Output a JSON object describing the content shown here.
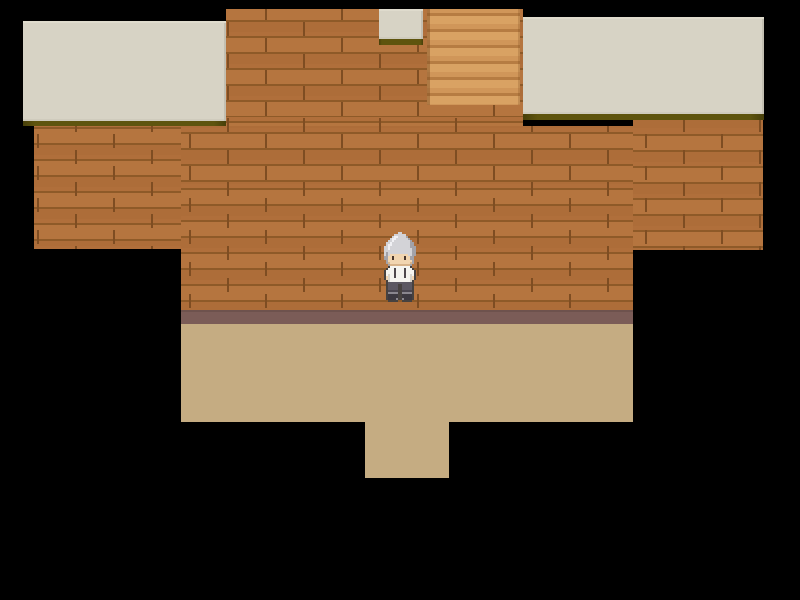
{
  "meta": {
    "description": "Top-down 2D RPG interior scene: brown wooden-plank walls, beige ceiling panels, a staircase at top center, tan floor with lower doorway, and a gray-haired character standing at center. No on-screen text.",
    "viewport": {
      "width": 800,
      "height": 600
    }
  },
  "scene": {
    "background_color": "#000000",
    "palette": {
      "wall_base": "#b5753f",
      "wall_groove": "#8e5a28",
      "wall_joint": "#7e4d22",
      "stairs_light": "#d9a263",
      "stairs_mid": "#d09659",
      "stairs_groove": "#b67c42",
      "ceiling": "#d7d3c5",
      "ceiling_shadow": "#5e540e",
      "baseboard": "#7b5c57",
      "floor": "#c5ac82",
      "void": "#000000"
    },
    "regions": [
      {
        "name": "wall-top-column",
        "type": "wall",
        "x": 226,
        "y": 9,
        "w": 297,
        "h": 117,
        "interactable": false
      },
      {
        "name": "wall-left-wing",
        "type": "wall",
        "x": 34,
        "y": 126,
        "w": 147,
        "h": 123,
        "interactable": false
      },
      {
        "name": "wall-center",
        "type": "wall",
        "x": 181,
        "y": 126,
        "w": 452,
        "h": 184,
        "interactable": false
      },
      {
        "name": "wall-right-wing",
        "type": "wall",
        "x": 633,
        "y": 120,
        "w": 130,
        "h": 130,
        "interactable": false
      },
      {
        "name": "staircase",
        "type": "stairs",
        "x": 427,
        "y": 9,
        "w": 93,
        "h": 96,
        "interactable": true
      },
      {
        "name": "ceiling-panel-left",
        "type": "ceiling",
        "x": 23,
        "y": 21,
        "w": 203,
        "h": 100,
        "interactable": false
      },
      {
        "name": "ceiling-shadow-left",
        "type": "shadow",
        "x": 23,
        "y": 121,
        "w": 203,
        "h": 5,
        "interactable": false
      },
      {
        "name": "ceiling-panel-right",
        "type": "ceiling",
        "x": 523,
        "y": 17,
        "w": 241,
        "h": 97,
        "interactable": false
      },
      {
        "name": "ceiling-shadow-right",
        "type": "shadow",
        "x": 523,
        "y": 114,
        "w": 241,
        "h": 6,
        "interactable": false
      },
      {
        "name": "ceiling-panel-top-door",
        "type": "ceiling",
        "x": 379,
        "y": 9,
        "w": 44,
        "h": 30,
        "interactable": false
      },
      {
        "name": "ceiling-shadow-top-door",
        "type": "shadow",
        "x": 379,
        "y": 39,
        "w": 44,
        "h": 6,
        "interactable": false
      },
      {
        "name": "baseboard-strip",
        "type": "baseboard",
        "x": 181,
        "y": 310,
        "w": 452,
        "h": 14,
        "interactable": false
      },
      {
        "name": "floor-main",
        "type": "floor",
        "x": 181,
        "y": 324,
        "w": 452,
        "h": 98,
        "interactable": true
      },
      {
        "name": "floor-entry-south",
        "type": "floor",
        "x": 365,
        "y": 422,
        "w": 84,
        "h": 56,
        "interactable": true
      }
    ],
    "character": {
      "name": "gray-haired-villager",
      "facing": "down",
      "x": 382,
      "y": 232,
      "width": 36,
      "height": 70,
      "cols": 18,
      "pixel_palette": {
        "O": "#474240",
        "H": "#d3d3d7",
        "W": "#f1f1f4",
        "h": "#a2a2a8",
        "S": "#f1d5b0",
        "s": "#d7b38a",
        "E": "#49362c",
        "T": "#f5f4ef",
        "t": "#d8d5cd",
        "D": "#4e484c",
        "P": "#5c5862",
        "p": "#4a4650",
        "B": "#3c3941",
        "b": "#8a878f"
      },
      "rows": [
        "........HH........",
        "......HHHHHH......",
        ".....HWWHHHHh.....",
        "....HWWHHHHHHh....",
        "...HHWHHHHHHHHh...",
        "..HHWHHHHHHHHHhh..",
        "..HWWHHHHHHHHHhh..",
        ".HHWHHHHHHHHHHhhh.",
        ".HHWHHHHHHHHHHHhh.",
        ".HHHHHHHHHHHHHHhh.",
        ".HhHHHHHHHHHHHHhh.",
        ".HhHSSSSSSSSSHHhh.",
        ".hhSSESSSSSESShh..",
        ".hhSSESSSSSESShh..",
        "..hSSSSSSSSSSSSh..",
        "..hsSSSSSSSSSSsh..",
        "...hssssssssssh...",
        "...OTTTTTTTTTTO...",
        "..OTTTDTTTTDTTTO..",
        ".OTTTTDTTTTDTTTTO.",
        ".OTTTTDTTTTDTTTTO.",
        ".OTtTTDTTTTDTTtTO.",
        ".OStTTDTTTTDTTtSO.",
        ".OStTTTTTTTTTTtSO.",
        "..OtTTTTTTTTTTtO..",
        "..OPPPPPPPPPPPPO..",
        "..OPPPPPOOPPPPPO..",
        "..OPPPPPOOPPPPPO..",
        "..OPPPPPOOPPPPPO..",
        "..OpppppOOpppppO..",
        "..ObbbbbOObbbbbO..",
        "..OBBBBBOOBBBBBO..",
        "..OBBBBBOOBBBBBO..",
        "..OBBBBbOObBBBBO..",
        "...OOOOO..OOOOO..."
      ]
    }
  }
}
